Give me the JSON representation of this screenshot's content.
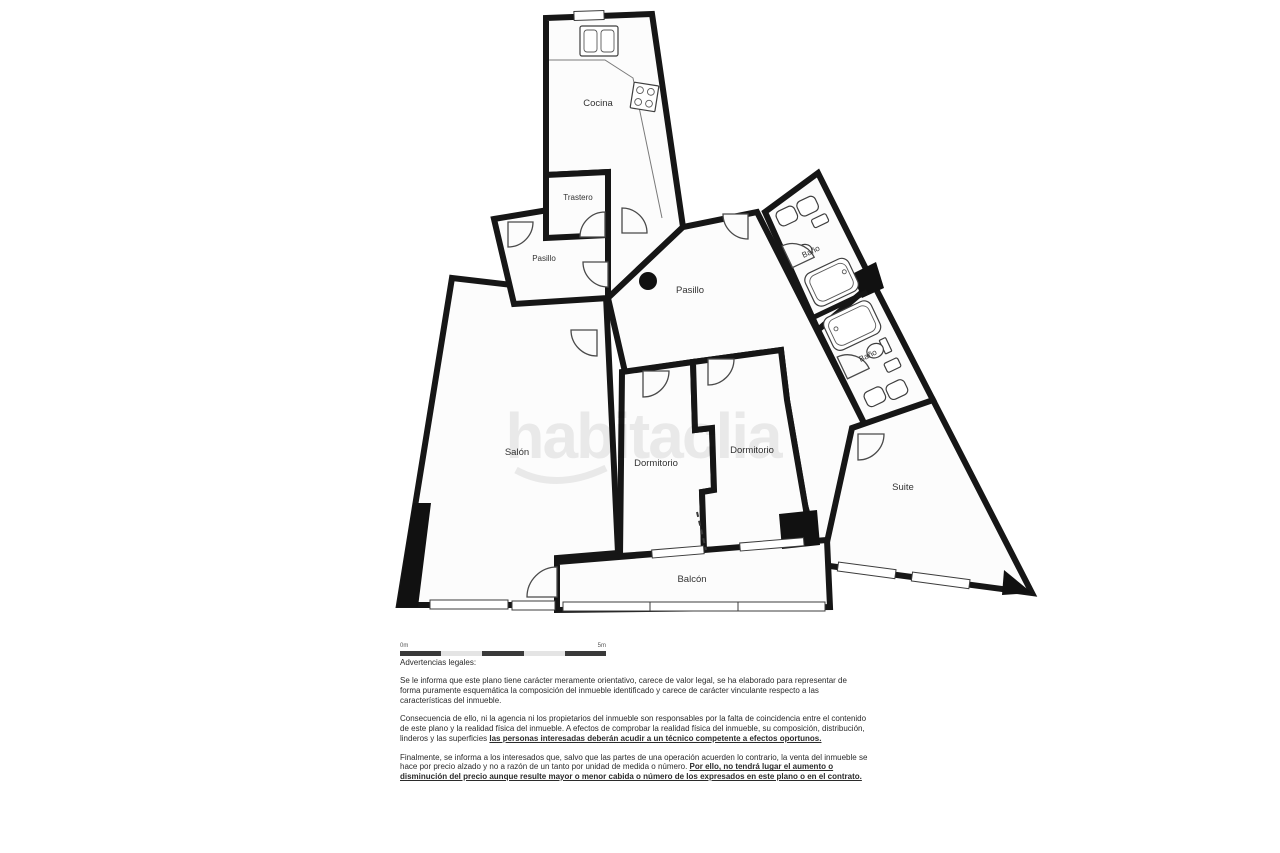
{
  "plan": {
    "watermark": "habitaclia",
    "rooms": [
      {
        "id": "cocina",
        "label": "Cocina"
      },
      {
        "id": "trastero",
        "label": "Trastero"
      },
      {
        "id": "pasillo-small",
        "label": "Pasillo"
      },
      {
        "id": "pasillo-central",
        "label": "Pasillo"
      },
      {
        "id": "bano-1",
        "label": "Baño"
      },
      {
        "id": "bano-2",
        "label": "Baño"
      },
      {
        "id": "salon",
        "label": "Salón"
      },
      {
        "id": "dormitorio-1",
        "label": "Dormitorio"
      },
      {
        "id": "dormitorio-2",
        "label": "Dormitorio"
      },
      {
        "id": "suite",
        "label": "Suite"
      },
      {
        "id": "balcon",
        "label": "Balcón"
      }
    ],
    "colors": {
      "wall": "#161616",
      "floor": "#fcfcfc",
      "watermark": "rgba(0,0,0,0.075)"
    }
  },
  "scalebar": {
    "start_label": "0m",
    "end_label": "5m"
  },
  "legal": {
    "title": "Advertencias legales:",
    "paragraphs": [
      {
        "normal": "Se le informa que este plano tiene carácter meramente orientativo, carece de valor legal, se ha elaborado para representar de forma puramente esquemática la composición del inmueble identificado y carece de carácter vinculante respecto a las características del inmueble.",
        "bold": ""
      },
      {
        "normal": "Consecuencia de ello, ni la agencia ni los propietarios del inmueble son responsables por la falta de coincidencia entre el contenido de este plano y la realidad física del inmueble. A efectos de comprobar la realidad física del inmueble, su composición, distribución, linderos y las superficies ",
        "bold": "las personas interesadas deberán acudir a un técnico competente a efectos oportunos."
      },
      {
        "normal": "Finalmente, se informa a los interesados que, salvo que las partes de una operación acuerden lo contrario, la venta del inmueble se hace por precio alzado y no a razón de un tanto por unidad de medida o número. ",
        "bold": "Por ello, no tendrá lugar el aumento o disminución del precio aunque resulte mayor o menor cabida o número de los expresados en este plano o en el contrato."
      }
    ]
  }
}
